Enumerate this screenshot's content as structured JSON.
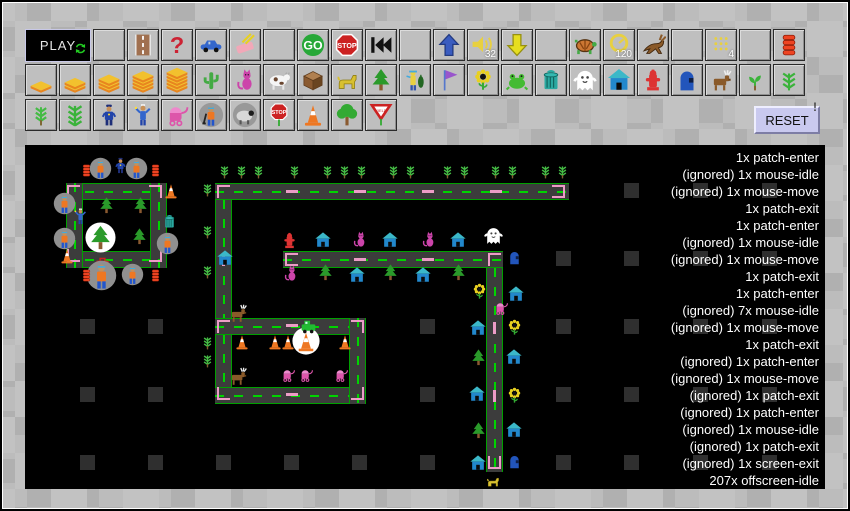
{
  "toolbar": {
    "play_label": "PLAY",
    "reset_label": "RESET",
    "reset_hint": "!",
    "row1": [
      {
        "icon": "blank"
      },
      {
        "icon": "road"
      },
      {
        "icon": "question"
      },
      {
        "icon": "car"
      },
      {
        "icon": "eraser"
      },
      {
        "icon": "blank"
      },
      {
        "icon": "go"
      },
      {
        "icon": "stop-sign"
      },
      {
        "icon": "rewind"
      },
      {
        "icon": "blank"
      },
      {
        "icon": "arrow-up"
      },
      {
        "icon": "speaker",
        "label": "32"
      },
      {
        "icon": "arrow-down"
      },
      {
        "icon": "blank"
      },
      {
        "icon": "turtle"
      },
      {
        "icon": "timer",
        "label": "120"
      },
      {
        "icon": "rabbit"
      },
      {
        "icon": "blank"
      },
      {
        "icon": "dots",
        "label": "4"
      },
      {
        "icon": "blank"
      },
      {
        "icon": "spool"
      }
    ],
    "row2": [
      {
        "icon": "tile-1"
      },
      {
        "icon": "tile-2"
      },
      {
        "icon": "tile-3"
      },
      {
        "icon": "tile-4"
      },
      {
        "icon": "tile-5"
      },
      {
        "icon": "cactus"
      },
      {
        "icon": "cat"
      },
      {
        "icon": "cow"
      },
      {
        "icon": "crate"
      },
      {
        "icon": "dog"
      },
      {
        "icon": "pine"
      },
      {
        "icon": "fisherman"
      },
      {
        "icon": "flag"
      },
      {
        "icon": "sunflower"
      },
      {
        "icon": "frog"
      },
      {
        "icon": "trash"
      },
      {
        "icon": "ghost"
      },
      {
        "icon": "house"
      },
      {
        "icon": "hydrant"
      },
      {
        "icon": "mailbox"
      },
      {
        "icon": "moose"
      },
      {
        "icon": "sprout"
      },
      {
        "icon": "plant"
      }
    ],
    "row3": [
      {
        "icon": "wheat"
      },
      {
        "icon": "plant-big"
      },
      {
        "icon": "police"
      },
      {
        "icon": "person"
      },
      {
        "icon": "stroller"
      },
      {
        "icon": "digger"
      },
      {
        "icon": "sheep"
      },
      {
        "icon": "stop-pole"
      },
      {
        "icon": "cone"
      },
      {
        "icon": "tree"
      },
      {
        "icon": "yield"
      }
    ]
  },
  "stage": {
    "grid_squares": [
      [
        621,
        180
      ],
      [
        690,
        180
      ],
      [
        759,
        180
      ],
      [
        553,
        248
      ],
      [
        621,
        248
      ],
      [
        690,
        248
      ],
      [
        759,
        248
      ],
      [
        77,
        316
      ],
      [
        145,
        316
      ],
      [
        417,
        316
      ],
      [
        553,
        316
      ],
      [
        621,
        316
      ],
      [
        690,
        316
      ],
      [
        759,
        316
      ],
      [
        77,
        384
      ],
      [
        145,
        384
      ],
      [
        417,
        384
      ],
      [
        553,
        384
      ],
      [
        621,
        384
      ],
      [
        690,
        384
      ],
      [
        759,
        384
      ],
      [
        77,
        452
      ],
      [
        145,
        452
      ],
      [
        213,
        452
      ],
      [
        281,
        452
      ],
      [
        349,
        452
      ],
      [
        417,
        452
      ],
      [
        553,
        452
      ],
      [
        621,
        452
      ],
      [
        690,
        452
      ],
      [
        759,
        452
      ]
    ],
    "roads": [
      {
        "o": "h",
        "x": 63,
        "y": 180,
        "l": 101
      },
      {
        "o": "h",
        "x": 63,
        "y": 248,
        "l": 101
      },
      {
        "o": "v",
        "x": 63,
        "y": 180,
        "l": 85
      },
      {
        "o": "v",
        "x": 147,
        "y": 180,
        "l": 85
      },
      {
        "o": "h",
        "x": 212,
        "y": 180,
        "l": 354
      },
      {
        "o": "v",
        "x": 212,
        "y": 197,
        "l": 119
      },
      {
        "o": "h",
        "x": 280,
        "y": 248,
        "l": 220
      },
      {
        "o": "v",
        "x": 483,
        "y": 265,
        "l": 204
      },
      {
        "o": "h",
        "x": 212,
        "y": 315,
        "l": 151
      },
      {
        "o": "h",
        "x": 212,
        "y": 384,
        "l": 151
      },
      {
        "o": "v",
        "x": 212,
        "y": 332,
        "l": 52
      },
      {
        "o": "v",
        "x": 346,
        "y": 315,
        "l": 86
      }
    ],
    "patches": [
      {
        "x": 64,
        "y": 182,
        "t": "tl"
      },
      {
        "x": 146,
        "y": 182,
        "t": "tr"
      },
      {
        "x": 64,
        "y": 246,
        "t": "bl"
      },
      {
        "x": 146,
        "y": 246,
        "t": "br"
      },
      {
        "x": 214,
        "y": 182,
        "t": "tl"
      },
      {
        "x": 549,
        "y": 182,
        "t": "trb"
      },
      {
        "x": 282,
        "y": 250,
        "t": "tlb"
      },
      {
        "x": 485,
        "y": 250,
        "t": "tl"
      },
      {
        "x": 214,
        "y": 317,
        "t": "tl"
      },
      {
        "x": 348,
        "y": 317,
        "t": "tr"
      },
      {
        "x": 214,
        "y": 384,
        "t": "bl"
      },
      {
        "x": 348,
        "y": 384,
        "t": "br"
      },
      {
        "x": 485,
        "y": 453,
        "t": "lrb"
      },
      {
        "x": 283,
        "y": 187,
        "t": "dh"
      },
      {
        "x": 351,
        "y": 187,
        "t": "dh"
      },
      {
        "x": 419,
        "y": 187,
        "t": "dh"
      },
      {
        "x": 487,
        "y": 187,
        "t": "dh"
      },
      {
        "x": 351,
        "y": 255,
        "t": "dh"
      },
      {
        "x": 419,
        "y": 255,
        "t": "dh"
      },
      {
        "x": 283,
        "y": 321,
        "t": "dh"
      },
      {
        "x": 283,
        "y": 390,
        "t": "dh"
      },
      {
        "x": 219,
        "y": 251,
        "t": "dv"
      },
      {
        "x": 490,
        "y": 319,
        "t": "dv"
      },
      {
        "x": 490,
        "y": 387,
        "t": "dv"
      }
    ],
    "sprites": [
      {
        "t": "spool",
        "x": 76,
        "y": 160
      },
      {
        "t": "worker",
        "x": 86,
        "y": 154
      },
      {
        "t": "police",
        "x": 108,
        "y": 153
      },
      {
        "t": "worker",
        "x": 122,
        "y": 154
      },
      {
        "t": "spool",
        "x": 145,
        "y": 160
      },
      {
        "t": "worker",
        "x": 50,
        "y": 189
      },
      {
        "t": "person",
        "x": 68,
        "y": 204
      },
      {
        "t": "worker",
        "x": 50,
        "y": 224
      },
      {
        "t": "cone",
        "x": 55,
        "y": 244
      },
      {
        "t": "cone",
        "x": 159,
        "y": 179
      },
      {
        "t": "trash",
        "x": 158,
        "y": 210
      },
      {
        "t": "worker",
        "x": 153,
        "y": 229
      },
      {
        "t": "pine",
        "x": 94,
        "y": 193
      },
      {
        "t": "pine",
        "x": 128,
        "y": 193
      },
      {
        "t": "pine",
        "x": 127,
        "y": 224
      },
      {
        "t": "bigtree",
        "x": 82,
        "y": 219
      },
      {
        "t": "toolbox",
        "x": 90,
        "y": 250
      },
      {
        "t": "worker-big",
        "x": 83,
        "y": 257
      },
      {
        "t": "worker",
        "x": 118,
        "y": 260
      },
      {
        "t": "spool",
        "x": 76,
        "y": 265
      },
      {
        "t": "spool",
        "x": 145,
        "y": 265
      },
      {
        "t": "wheat",
        "x": 213,
        "y": 160
      },
      {
        "t": "wheat",
        "x": 230,
        "y": 160
      },
      {
        "t": "wheat",
        "x": 247,
        "y": 160
      },
      {
        "t": "wheat",
        "x": 283,
        "y": 160
      },
      {
        "t": "wheat",
        "x": 316,
        "y": 160
      },
      {
        "t": "wheat",
        "x": 333,
        "y": 160
      },
      {
        "t": "wheat",
        "x": 350,
        "y": 160
      },
      {
        "t": "wheat",
        "x": 382,
        "y": 160
      },
      {
        "t": "wheat",
        "x": 399,
        "y": 160
      },
      {
        "t": "wheat",
        "x": 436,
        "y": 160
      },
      {
        "t": "wheat",
        "x": 453,
        "y": 160
      },
      {
        "t": "wheat",
        "x": 484,
        "y": 160
      },
      {
        "t": "wheat",
        "x": 501,
        "y": 160
      },
      {
        "t": "wheat",
        "x": 534,
        "y": 160
      },
      {
        "t": "wheat",
        "x": 551,
        "y": 160
      },
      {
        "t": "wheat",
        "x": 196,
        "y": 178
      },
      {
        "t": "wheat",
        "x": 196,
        "y": 220
      },
      {
        "t": "wheat",
        "x": 196,
        "y": 260
      },
      {
        "t": "wheat",
        "x": 196,
        "y": 331
      },
      {
        "t": "wheat",
        "x": 196,
        "y": 349
      },
      {
        "t": "house",
        "x": 213,
        "y": 246
      },
      {
        "t": "hydrant",
        "x": 277,
        "y": 228
      },
      {
        "t": "house",
        "x": 311,
        "y": 228
      },
      {
        "t": "cat",
        "x": 347,
        "y": 227
      },
      {
        "t": "house",
        "x": 378,
        "y": 228
      },
      {
        "t": "cat",
        "x": 416,
        "y": 227
      },
      {
        "t": "house",
        "x": 446,
        "y": 228
      },
      {
        "t": "ghost",
        "x": 480,
        "y": 222
      },
      {
        "t": "mailbox",
        "x": 503,
        "y": 246
      },
      {
        "t": "cat",
        "x": 278,
        "y": 261
      },
      {
        "t": "pine",
        "x": 313,
        "y": 260
      },
      {
        "t": "house",
        "x": 345,
        "y": 263
      },
      {
        "t": "pine",
        "x": 378,
        "y": 260
      },
      {
        "t": "house",
        "x": 411,
        "y": 263
      },
      {
        "t": "pine",
        "x": 446,
        "y": 260
      },
      {
        "t": "sunflower",
        "x": 467,
        "y": 279
      },
      {
        "t": "house",
        "x": 504,
        "y": 282
      },
      {
        "t": "stroller",
        "x": 490,
        "y": 297
      },
      {
        "t": "moose",
        "x": 224,
        "y": 299
      },
      {
        "t": "house",
        "x": 466,
        "y": 316
      },
      {
        "t": "sunflower",
        "x": 502,
        "y": 315
      },
      {
        "t": "pine",
        "x": 466,
        "y": 345
      },
      {
        "t": "house",
        "x": 502,
        "y": 345
      },
      {
        "t": "house",
        "x": 465,
        "y": 382
      },
      {
        "t": "sunflower",
        "x": 502,
        "y": 383
      },
      {
        "t": "pine",
        "x": 466,
        "y": 418
      },
      {
        "t": "house",
        "x": 502,
        "y": 418
      },
      {
        "t": "house",
        "x": 466,
        "y": 451
      },
      {
        "t": "mailbox",
        "x": 503,
        "y": 450
      },
      {
        "t": "dog",
        "x": 482,
        "y": 470
      },
      {
        "t": "snowcone",
        "x": 289,
        "y": 324
      },
      {
        "t": "truck",
        "x": 295,
        "y": 313
      },
      {
        "t": "cone",
        "x": 230,
        "y": 330
      },
      {
        "t": "cone",
        "x": 263,
        "y": 330
      },
      {
        "t": "cone",
        "x": 276,
        "y": 330
      },
      {
        "t": "cone",
        "x": 333,
        "y": 330
      },
      {
        "t": "moose",
        "x": 224,
        "y": 362
      },
      {
        "t": "stroller",
        "x": 277,
        "y": 364
      },
      {
        "t": "stroller",
        "x": 295,
        "y": 364
      },
      {
        "t": "stroller",
        "x": 330,
        "y": 364
      }
    ],
    "log": [
      "1x patch-enter",
      "(ignored) 1x mouse-idle",
      "(ignored) 1x mouse-move",
      "1x patch-exit",
      "1x patch-enter",
      "(ignored) 1x mouse-idle",
      "(ignored) 1x mouse-move",
      "1x patch-exit",
      "1x patch-enter",
      "(ignored) 7x mouse-idle",
      "(ignored) 1x mouse-move",
      "1x patch-exit",
      "(ignored) 1x patch-enter",
      "(ignored) 1x mouse-move",
      "(ignored) 1x patch-exit",
      "(ignored) 1x patch-enter",
      "(ignored) 1x mouse-idle",
      "(ignored) 1x patch-exit",
      "(ignored) 1x screen-exit",
      "207x offscreen-idle"
    ]
  },
  "colors": {
    "patch_pink": "#ec9cc6",
    "road_edge_green": "#00a000",
    "road_dash_green": "#00d400",
    "stage_bg": "#000000",
    "reset_bg": "#c9c9ef"
  }
}
